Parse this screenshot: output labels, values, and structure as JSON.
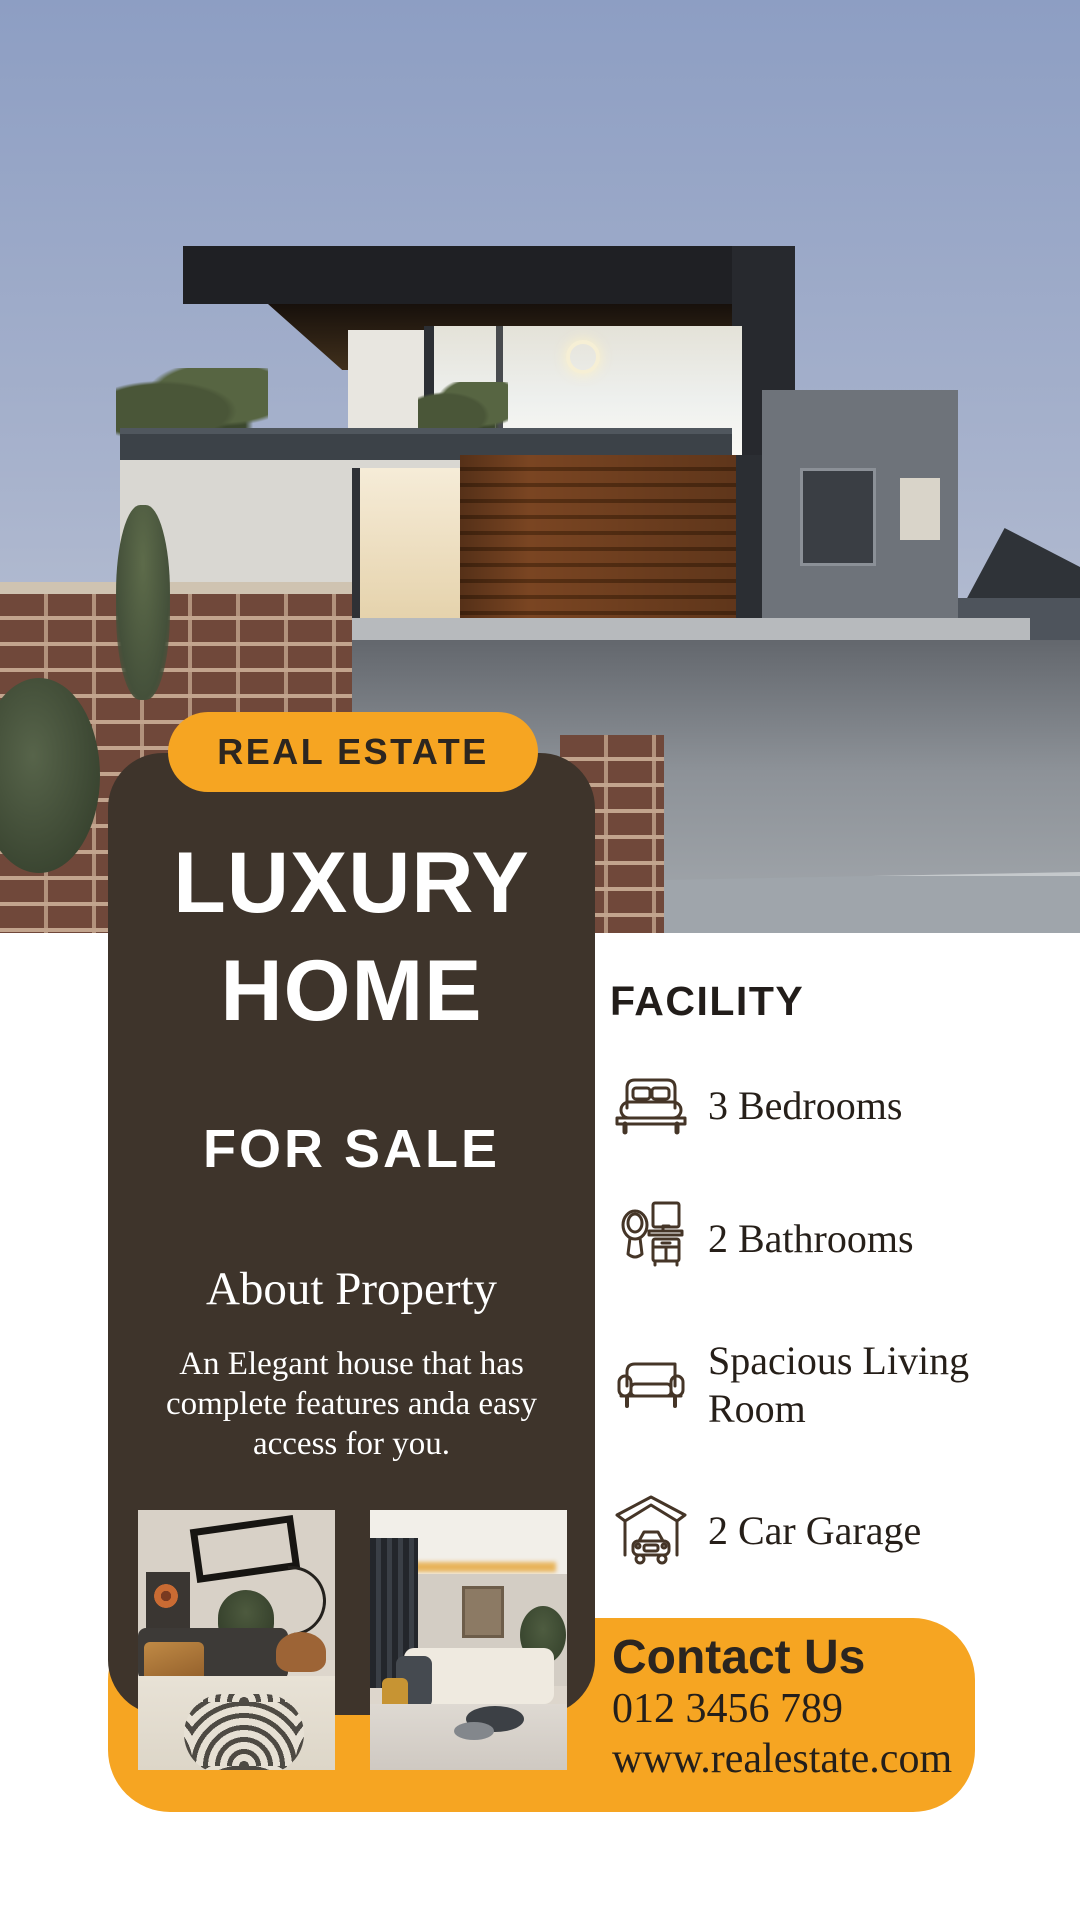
{
  "badge": {
    "label": "REAL ESTATE"
  },
  "card": {
    "title_line1": "LUXURY",
    "title_line2": "HOME",
    "subtitle": "FOR SALE",
    "about_heading": "About Property",
    "about_lines": [
      "An Elegant house that has",
      "complete features anda easy",
      "access for you."
    ]
  },
  "facility": {
    "title": "FACILITY",
    "items": [
      {
        "icon": "bed-icon",
        "label": "3 Bedrooms"
      },
      {
        "icon": "bathroom-icon",
        "label": "2 Bathrooms"
      },
      {
        "icon": "sofa-icon",
        "label": "Spacious Living Room",
        "lines": [
          "Spacious Living",
          "Room"
        ]
      },
      {
        "icon": "garage-icon",
        "label": "2 Car Garage"
      }
    ]
  },
  "contact": {
    "heading": "Contact Us",
    "phone": "012 3456 789",
    "website": "www.realestate.com"
  },
  "hero": {
    "alt": "Modern two-story luxury house at dusk with wooden garage door"
  },
  "colors": {
    "accent_orange": "#F6A522",
    "card_brown": "#3E342B",
    "dark_text": "#272220",
    "sky_top": "#8D9EC3",
    "sky_bottom": "#C7CCD8"
  }
}
